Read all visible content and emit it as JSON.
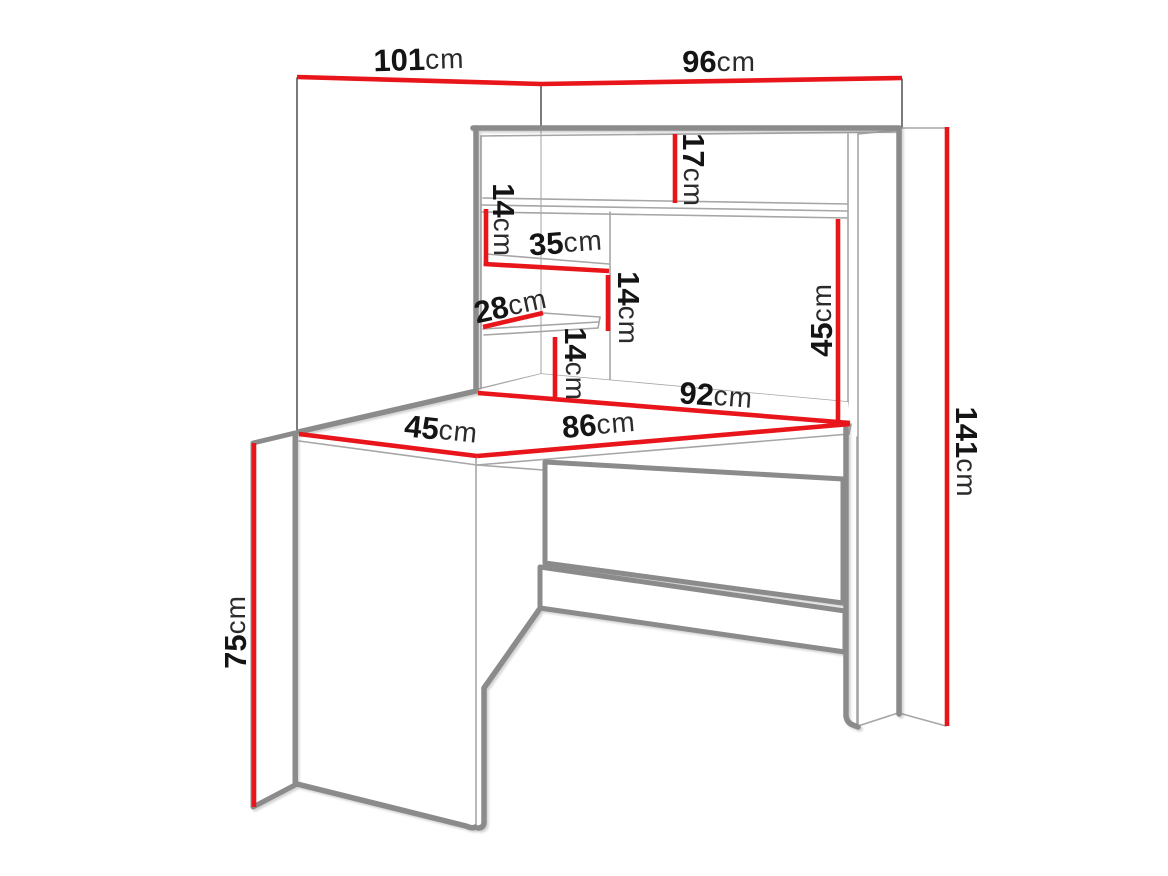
{
  "title": "Corner desk with hutch — dimension diagram",
  "colors": {
    "dimension": "#e8151b",
    "outline": "#8b8b8b",
    "inner": "#a6a6a6",
    "wall": "#5a5a5a",
    "text": "#141414",
    "bg": "#ffffff"
  },
  "dimensions": {
    "wall_left": {
      "num": "101",
      "unit": "cm"
    },
    "wall_right": {
      "num": "96",
      "unit": "cm"
    },
    "total_height": {
      "num": "141",
      "unit": "cm"
    },
    "top_gap": {
      "num": "17",
      "unit": "cm"
    },
    "shelf_gap_1": {
      "num": "14",
      "unit": "cm"
    },
    "shelf_width": {
      "num": "35",
      "unit": "cm"
    },
    "shelf_gap_2": {
      "num": "14",
      "unit": "cm"
    },
    "shelf_depth": {
      "num": "28",
      "unit": "cm"
    },
    "shelf_gap_3": {
      "num": "14",
      "unit": "cm"
    },
    "hutch_opening": {
      "num": "45",
      "unit": "cm"
    },
    "desk_back_edge": {
      "num": "92",
      "unit": "cm"
    },
    "desk_left_edge": {
      "num": "45",
      "unit": "cm"
    },
    "desk_front_edge": {
      "num": "86",
      "unit": "cm"
    },
    "desk_height": {
      "num": "75",
      "unit": "cm"
    }
  }
}
